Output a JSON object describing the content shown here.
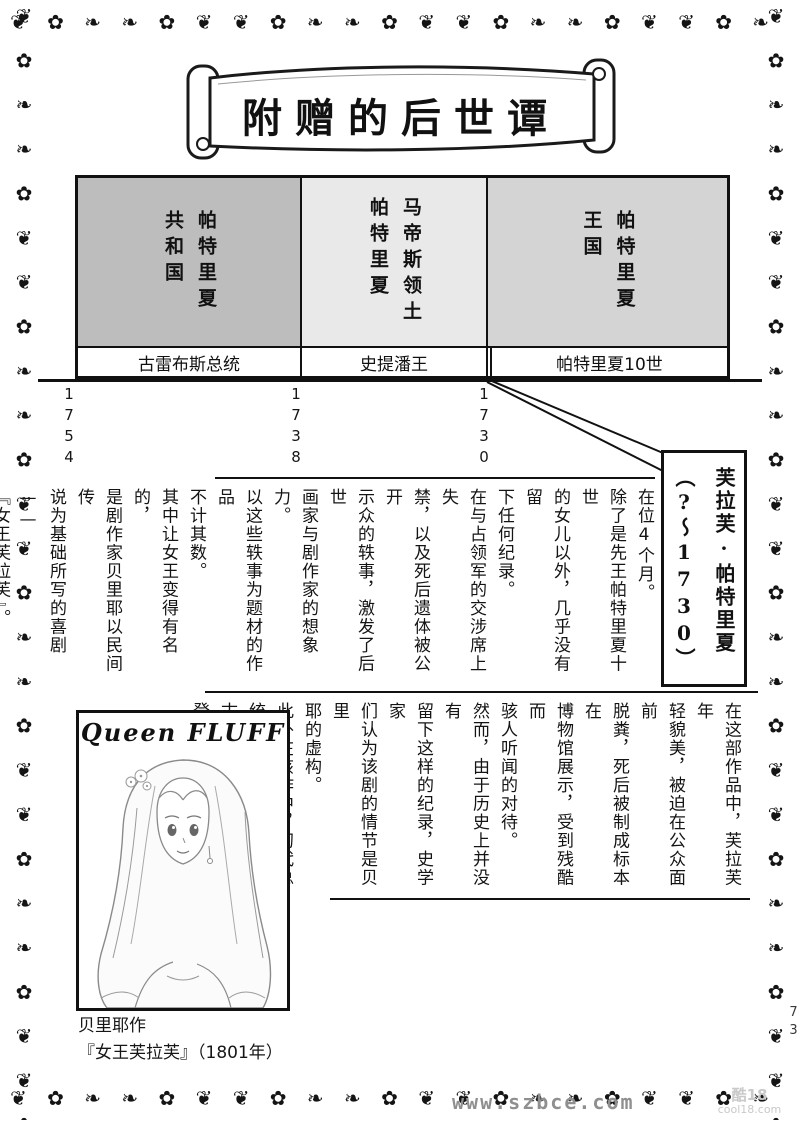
{
  "page": {
    "title": "附赠的后世谭",
    "page_number": "73",
    "watermark_center": "www.szbce.com",
    "watermark_corner_line1": "酷18",
    "watermark_corner_line2": "cool18.com"
  },
  "border": {
    "pattern": "❦ ✿ ❧ ❧ ✿ ❦ ❦ ✿ ❧ ❧ ✿ ❦ ❦ ✿ ❧ ❧ ✿ ❦ ❦ ✿ ❧ ❧ ✿ ❦ ❦ ✿ ❧ ❧ ✿ ❦ ❦ ✿ ❧ ❧ ✿ ❦ ❦ ✿ ❧ ❧ ✿ ❦ ❦ ✿ ❧ ❧ ✿ ❦ ❦ ✿ ❧ ❧ ✿ ❦ ❦ ✿ ❧ ❧ ✿ ❦ ❦ ✿ ❧ ❧ ✿ ❦ ❦ ✿ ❧ ❧ ✿ ❦ ❦ ✿ ❧ ❧ ✿ ❦"
  },
  "colors": {
    "era1_bg": "#bdbdbd",
    "era2_bg": "#e9e9e9",
    "era3_bg": "#d4d4d4",
    "line": "#111111"
  },
  "timeline": {
    "eras": [
      {
        "name": "帕特里夏\n共和国",
        "ruler": "古雷布斯总统",
        "start_year": "1754"
      },
      {
        "name": "马帝斯领土\n帕特里夏",
        "ruler": "史提潘王",
        "start_year": "1738"
      },
      {
        "name": "帕特里夏\n王国",
        "ruler": "帕特里夏10世",
        "start_year": "1730"
      }
    ]
  },
  "callout": {
    "title": "芙拉芙·帕特里夏\n（?～1730）"
  },
  "bio": {
    "paragraphs": [
      "在位4个月。\n除了是先王帕特里夏十世\n的女儿以外，几乎没有留\n下任何纪录。",
      "在与占领军的交涉席上失\n禁，以及死后遗体被公开\n示众的轶事，激发了后世\n画家与剧作家的想象力。\n以这些轶事为题材的作品\n不计其数。",
      "其中让女王变得有名的，\n是剧作家贝里耶以民间传\n说为基础所写的喜剧——\n『女王芙拉芙』。"
    ]
  },
  "play": {
    "paragraphs": [
      "在这部作品中，芙拉芙年\n轻貌美，被迫在公众面前\n脱粪，死后被制成标本在\n博物馆展示，受到残酷而\n骇人听闻的对待。",
      "然而，由于历史上并没有\n留下这样的纪录，史学家\n们认为该剧的情节是贝里\n耶的虚构。",
      "此外在该作中，初代总统\n古雷布斯作为反派角色\n登场。"
    ]
  },
  "illustration": {
    "header": "Queen FLUFF",
    "caption_line1": "贝里耶作",
    "caption_line2": "『女王芙拉芙』（1801年）"
  }
}
